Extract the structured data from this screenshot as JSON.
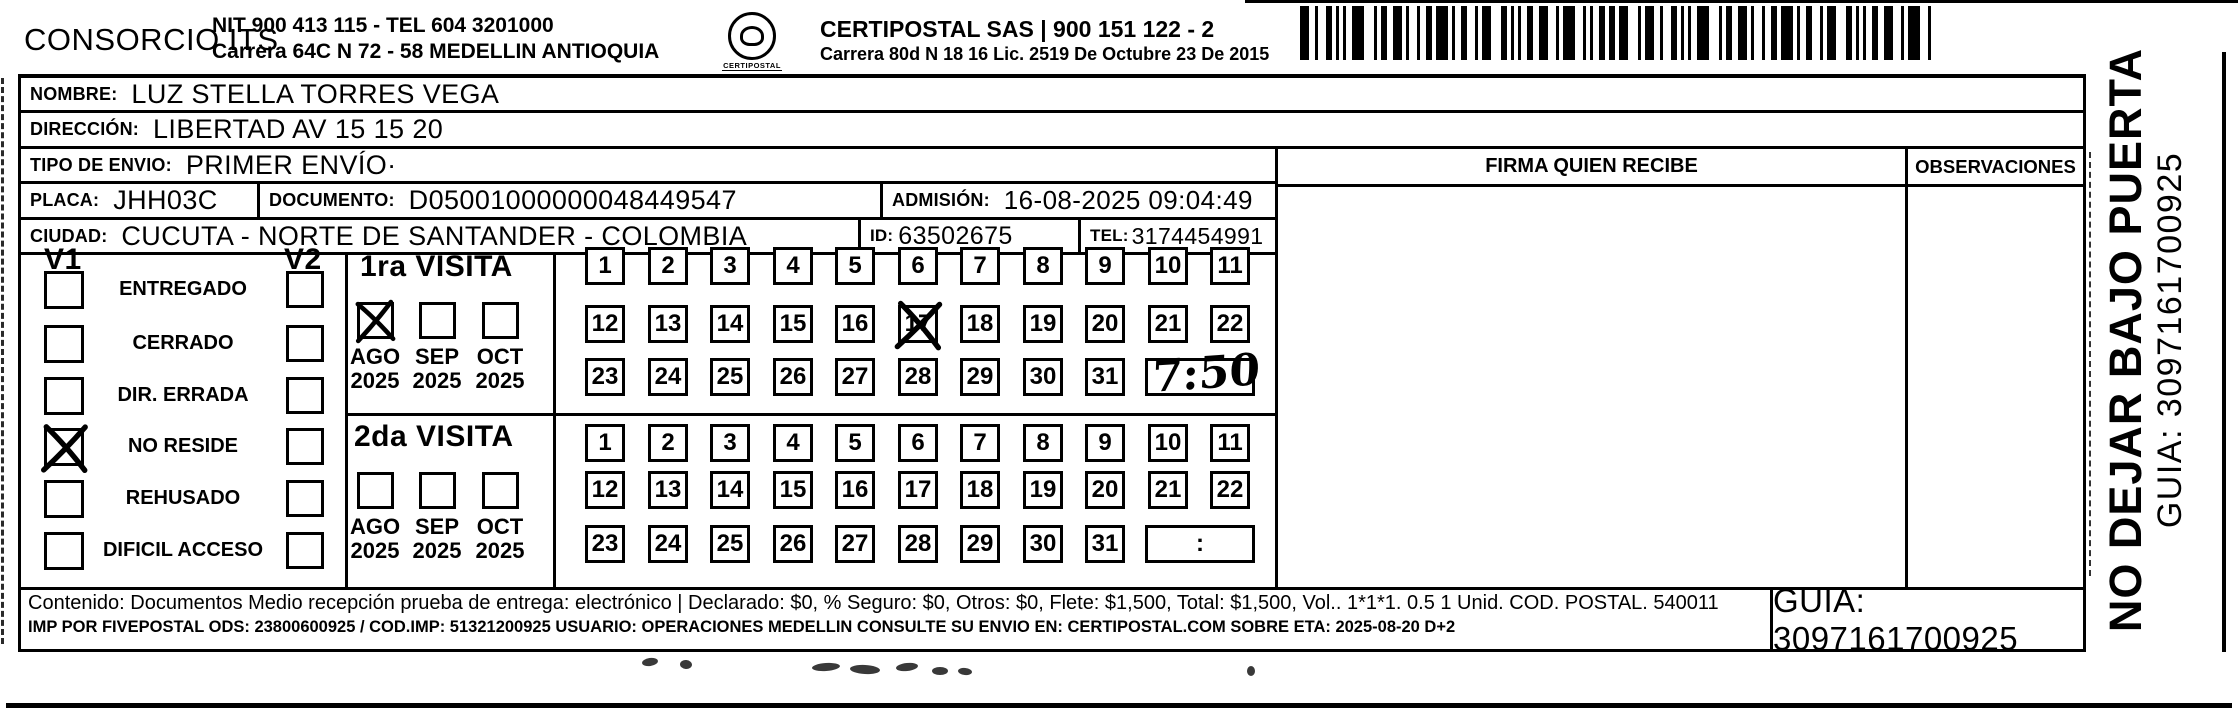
{
  "colors": {
    "ink": "#000000",
    "paper": "#ffffff"
  },
  "icons": {
    "barcode": "barcode-icon",
    "stamp": "certipostal-stamp-icon",
    "handwritten_check": "x-mark-icon"
  },
  "header": {
    "company_name": "CONSORCIO ITS",
    "company_nit_tel": "NIT 900 413 115 - TEL 604 3201000",
    "company_address": "Carrera 64C N 72 - 58 MEDELLIN ANTIOQUIA",
    "logo_caption": "CERTIPOSTAL",
    "operator_name_line": "CERTIPOSTAL SAS | 900 151 122 - 2",
    "operator_address_line": "Carrera 80d N 18 16  Lic. 2519 De Octubre 23 De 2015"
  },
  "fields": {
    "nombre": {
      "label": "NOMBRE:",
      "value": "LUZ STELLA TORRES VEGA"
    },
    "direccion": {
      "label": "DIRECCIÓN:",
      "value": "LIBERTAD AV 15 15 20"
    },
    "tipo_envio": {
      "label": "TIPO DE ENVIO:",
      "value": "PRIMER ENVÍO·"
    },
    "placa": {
      "label": "PLACA:",
      "value": "JHH03C"
    },
    "documento": {
      "label": "DOCUMENTO:",
      "value": "D05001000000048449547"
    },
    "admision": {
      "label": "ADMISIÓN:",
      "value": "16-08-2025 09:04:49"
    },
    "ciudad": {
      "label": "CIUDAD:",
      "value": "CUCUTA - NORTE DE SANTANDER - COLOMBIA"
    },
    "id": {
      "label": "ID:",
      "value": "63502675"
    },
    "tel": {
      "label": "TEL:",
      "value": "3174454991"
    }
  },
  "status_panel": {
    "col1_header": "V1",
    "col2_header": "V2",
    "options": [
      "ENTREGADO",
      "CERRADO",
      "DIR. ERRADA",
      "NO RESIDE",
      "REHUSADO",
      "DIFICIL ACCESO"
    ],
    "v1_checked_option": "NO RESIDE"
  },
  "visits": {
    "months": [
      "AGO",
      "SEP",
      "OCT"
    ],
    "year": "2025",
    "day_rows": [
      [
        1,
        2,
        3,
        4,
        5,
        6,
        7,
        8,
        9,
        10,
        11
      ],
      [
        12,
        13,
        14,
        15,
        16,
        17,
        18,
        19,
        20,
        21,
        22
      ],
      [
        23,
        24,
        25,
        26,
        27,
        28,
        29,
        30,
        31
      ]
    ],
    "first": {
      "title": "1ra VISITA",
      "checked_month": "AGO",
      "checked_day": 17,
      "handwritten_time": "7:50"
    },
    "second": {
      "title": "2da VISITA",
      "checked_month": null,
      "checked_day": null,
      "time_placeholder": ":"
    }
  },
  "signature_panel": {
    "firma_header": "FIRMA QUIEN RECIBE",
    "observaciones_header": "OBSERVACIONES"
  },
  "side_note": {
    "line1": "NO DEJAR BAJO PUERTA",
    "line2": "GUIA: 3097161700925"
  },
  "footer": {
    "content_line": "Contenido: Documentos Medio recepción prueba de entrega: electrónico | Declarado: $0, % Seguro: $0, Otros: $0, Flete: $1,500, Total: $1,500, Vol.. 1*1*1. 0.5  1 Unid. COD. POSTAL. 540011",
    "imp_line": "IMP POR FIVEPOSTAL ODS: 23800600925 / COD.IMP: 51321200925 USUARIO: OPERACIONES MEDELLIN CONSULTE SU ENVIO EN: CERTIPOSTAL.COM SOBRE ETA: 2025-08-20 D+2",
    "guia": "GUIA: 3097161700925"
  }
}
